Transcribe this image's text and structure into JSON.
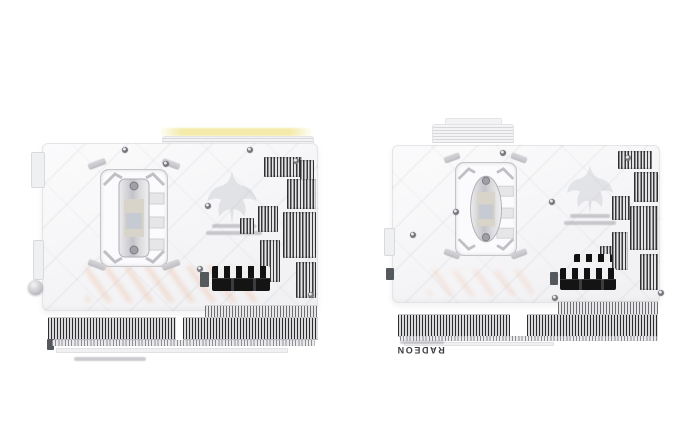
{
  "scene": {
    "description": "Product photo: two white Radeon graphics cards shown from the backplate side, placed side by side on a white background",
    "background_color": "#ffffff"
  },
  "colors": {
    "backplate_white": "#f8f8f9",
    "backplate_border": "#e5e5e8",
    "heatsink_fin_dark": "#2c2c2e",
    "heatsink_fin_light": "#dadadc",
    "power_connector_black": "#141414",
    "top_strip_yellow": "#f4ebab",
    "warm_reflection_copper": "#eeaa82",
    "bracket_silver": "#c9c9ce",
    "edge_text_color": "#3a3d42"
  },
  "cards": [
    {
      "name": "left graphics card backplate",
      "emblem": "eagle-emblem",
      "bottom_edge_text": ""
    },
    {
      "name": "right graphics card backplate",
      "emblem": "eagle-emblem",
      "bottom_edge_text": "RADEON"
    }
  ]
}
